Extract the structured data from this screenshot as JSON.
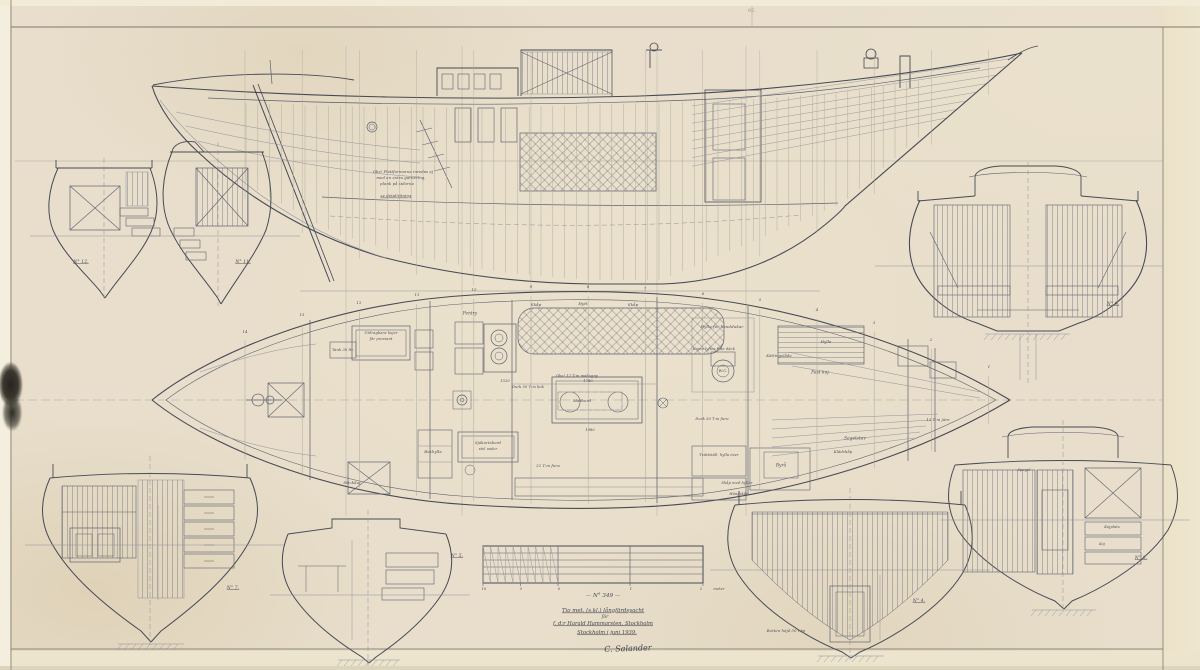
{
  "drawing": {
    "title_block": {
      "drawing_no": "— N° 349 —",
      "line1": "Tio met. (s.kl.) långfärdsyacht",
      "line2": "för",
      "line3": "f. d:r Harald Hammarsten, Stockholm",
      "line4": "Stockholm i juni 1939.",
      "signature": "C. Salander"
    },
    "station_numbers": [
      "14",
      "13",
      "12",
      "11",
      "10",
      "9",
      "8",
      "7",
      "6",
      "5",
      "4",
      "3",
      "2",
      "1"
    ],
    "labels": [
      {
        "n": "sheet-mark",
        "t": "92.",
        "x": 752,
        "y": 11,
        "s": 5,
        "c": "faint"
      },
      {
        "n": "frame-label-12",
        "t": "N° 12.",
        "x": 81,
        "y": 262,
        "s": 4.5,
        "u": 1
      },
      {
        "n": "frame-label-11",
        "t": "N° 11.",
        "x": 243,
        "y": 262,
        "s": 4.5,
        "u": 1
      },
      {
        "n": "frame-label-9",
        "t": "N° 9.",
        "x": 1113,
        "y": 304,
        "s": 4.5,
        "u": 1
      },
      {
        "n": "frame-label-7",
        "t": "N° 7.",
        "x": 233,
        "y": 588,
        "s": 4.5,
        "u": 1
      },
      {
        "n": "frame-label-5",
        "t": "N° 5.",
        "x": 457,
        "y": 556,
        "s": 4.5,
        "u": 1
      },
      {
        "n": "frame-label-4",
        "t": "N° 4.",
        "x": 919,
        "y": 601,
        "s": 4.5,
        "u": 1
      },
      {
        "n": "frame-label-8",
        "t": "N° 8.",
        "x": 1141,
        "y": 558,
        "s": 4.5,
        "u": 1
      },
      {
        "n": "profile-note",
        "t": "Obs! Plattformarna inredas ej",
        "x": 403,
        "y": 172,
        "s": 3.8
      },
      {
        "n": "profile-note",
        "t": "med en extra garnering,",
        "x": 401,
        "y": 178,
        "s": 3.8
      },
      {
        "n": "profile-note",
        "t": "plank på sidorna",
        "x": 397,
        "y": 184,
        "s": 3.8
      },
      {
        "n": "profile-note",
        "t": "se detaljritning",
        "x": 396,
        "y": 196,
        "s": 3.8,
        "u": 1
      },
      {
        "n": "plan-label",
        "t": "Pentry",
        "x": 470,
        "y": 313,
        "s": 4.2
      },
      {
        "n": "plan-label",
        "t": "Skåp",
        "x": 536,
        "y": 305,
        "s": 4
      },
      {
        "n": "plan-label",
        "t": "Hytt",
        "x": 583,
        "y": 304,
        "s": 4
      },
      {
        "n": "plan-label",
        "t": "Skåp",
        "x": 633,
        "y": 305,
        "s": 4
      },
      {
        "n": "plan-label",
        "t": "Hylla för handdukar",
        "x": 722,
        "y": 327,
        "s": 4
      },
      {
        "n": "plan-label",
        "t": "Kojen lyftes från däck",
        "x": 714,
        "y": 349,
        "s": 3.6
      },
      {
        "n": "plan-label",
        "t": "W.C.",
        "x": 723,
        "y": 371,
        "s": 4
      },
      {
        "n": "plan-label",
        "t": "Hylla",
        "x": 826,
        "y": 342,
        "s": 3.8
      },
      {
        "n": "plan-label",
        "t": "Fast koj",
        "x": 820,
        "y": 372,
        "s": 4.2
      },
      {
        "n": "plan-label",
        "t": "Kättingslåda",
        "x": 779,
        "y": 356,
        "s": 3.8
      },
      {
        "n": "plan-label",
        "t": "12 T:m järn",
        "x": 938,
        "y": 420,
        "s": 3.8
      },
      {
        "n": "plan-label",
        "t": "Segelstuv",
        "x": 855,
        "y": 438,
        "s": 4.2
      },
      {
        "n": "plan-label",
        "t": "Byrå",
        "x": 781,
        "y": 465,
        "s": 4.2
      },
      {
        "n": "plan-label",
        "t": "Tvättställ, hylla över",
        "x": 719,
        "y": 455,
        "s": 3.6
      },
      {
        "n": "plan-label",
        "t": "Skåp med hyllor",
        "x": 737,
        "y": 483,
        "s": 3.6
      },
      {
        "n": "plan-label",
        "t": "Hängskåp",
        "x": 739,
        "y": 494,
        "s": 3.6
      },
      {
        "n": "plan-label",
        "t": "Klädskåp",
        "x": 843,
        "y": 452,
        "s": 3.8
      },
      {
        "n": "plan-label",
        "t": "Sjökortsbord",
        "x": 488,
        "y": 443,
        "s": 3.8
      },
      {
        "n": "plan-label",
        "t": "stol under",
        "x": 488,
        "y": 449,
        "s": 3.4
      },
      {
        "n": "plan-label",
        "t": "Bokhylla",
        "x": 433,
        "y": 452,
        "s": 3.8
      },
      {
        "n": "plan-label",
        "t": "Stickkoj",
        "x": 352,
        "y": 483,
        "s": 4
      },
      {
        "n": "plan-label",
        "t": "22 T:m furu",
        "x": 548,
        "y": 466,
        "s": 3.8
      },
      {
        "n": "plan-label",
        "t": "Matbord",
        "x": 582,
        "y": 401,
        "s": 4
      },
      {
        "n": "plan-label",
        "t": "Durk 50 T:m bok",
        "x": 528,
        "y": 387,
        "s": 3.6
      },
      {
        "n": "plan-label",
        "t": "Durk 30 T:m furu",
        "x": 712,
        "y": 419,
        "s": 3.6
      },
      {
        "n": "plan-label",
        "t": "Tank 30 ltr.",
        "x": 343,
        "y": 350,
        "s": 3.6
      },
      {
        "n": "plan-label",
        "t": "Utdragbara kojer",
        "x": 381,
        "y": 333,
        "s": 3.6
      },
      {
        "n": "plan-label",
        "t": "för proviant",
        "x": 381,
        "y": 339,
        "s": 3.6
      },
      {
        "n": "plan-label",
        "t": "Obs! 12 T:m mahogny",
        "x": 577,
        "y": 376,
        "s": 3.6
      },
      {
        "n": "dimension-label",
        "t": "1780",
        "x": 588,
        "y": 381,
        "s": 3.6
      },
      {
        "n": "dimension-label",
        "t": "1980",
        "x": 590,
        "y": 430,
        "s": 3.6
      },
      {
        "n": "dimension-label",
        "t": "1520",
        "x": 505,
        "y": 381,
        "s": 3.6
      },
      {
        "n": "section-label",
        "t": "Spegel",
        "x": 1024,
        "y": 470,
        "s": 3.6
      },
      {
        "n": "section-label",
        "t": "Kojplats",
        "x": 1112,
        "y": 527,
        "s": 3.6
      },
      {
        "n": "section-label",
        "t": "Koj",
        "x": 1102,
        "y": 544,
        "s": 3.4
      },
      {
        "n": "section-label",
        "t": "Botten höjd 30 c/m",
        "x": 786,
        "y": 631,
        "s": 3.8
      },
      {
        "n": "scale-tick",
        "t": "10",
        "x": 484,
        "y": 589,
        "s": 3.6
      },
      {
        "n": "scale-tick",
        "t": "5",
        "x": 521,
        "y": 589,
        "s": 3.6
      },
      {
        "n": "scale-tick",
        "t": "0",
        "x": 559,
        "y": 589,
        "s": 3.6
      },
      {
        "n": "scale-tick",
        "t": "1",
        "x": 631,
        "y": 589,
        "s": 3.6
      },
      {
        "n": "scale-tick",
        "t": "2",
        "x": 701,
        "y": 589,
        "s": 3.6
      },
      {
        "n": "scale-unit",
        "t": "meter",
        "x": 719,
        "y": 589,
        "s": 3.6
      }
    ],
    "colors": {
      "paper": "#e8decb",
      "ink_strong": "#474a55",
      "ink_medium": "#5e6170",
      "ink_light": "#8f919b",
      "stain": "#2c2a23"
    }
  }
}
